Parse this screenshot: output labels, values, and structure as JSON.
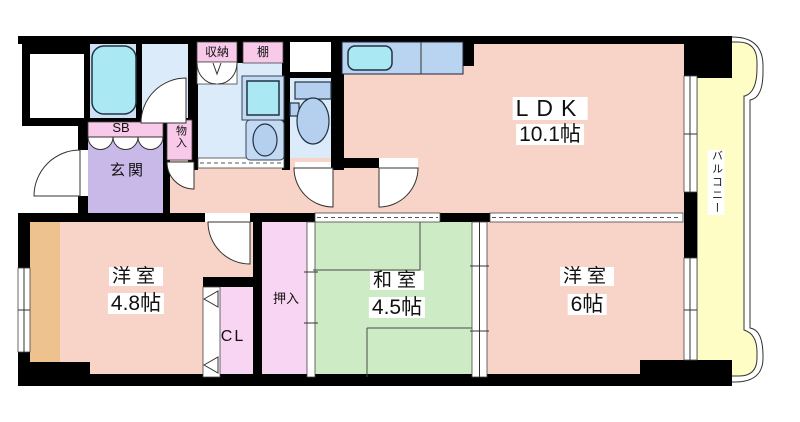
{
  "colors": {
    "wall": "#000000",
    "room-pink": "#f8d3c7",
    "tatami-green": "#cdecc6",
    "balcony-yellow": "#fdfdc5",
    "entrance-purple": "#c9b9e9",
    "label-pink": "#f9c9e9",
    "closet-pink": "#f8d5f2",
    "bath-blue": "#cfe1f5",
    "water-blue": "#dcebf9",
    "counter-blue": "#b9d4f0",
    "fixture-cyan": "#aae9f4",
    "fixture-blue": "#b4d0ee",
    "wood-tan": "#eec28f"
  },
  "rooms": {
    "ldk": {
      "name": "LDK",
      "size": "10.1帖"
    },
    "western1": {
      "name": "洋室",
      "size": "4.8帖"
    },
    "japanese": {
      "name": "和室",
      "size": "4.5帖"
    },
    "western2": {
      "name": "洋室",
      "size": "6帖"
    },
    "balcony": {
      "name": "バルコニー"
    },
    "entrance": {
      "name": "玄関"
    }
  },
  "storage": {
    "shoe_box": "SB",
    "small_storage": "物入",
    "storage": "収納",
    "shelf": "棚",
    "closet": "CL",
    "futon_closet": "押入"
  }
}
